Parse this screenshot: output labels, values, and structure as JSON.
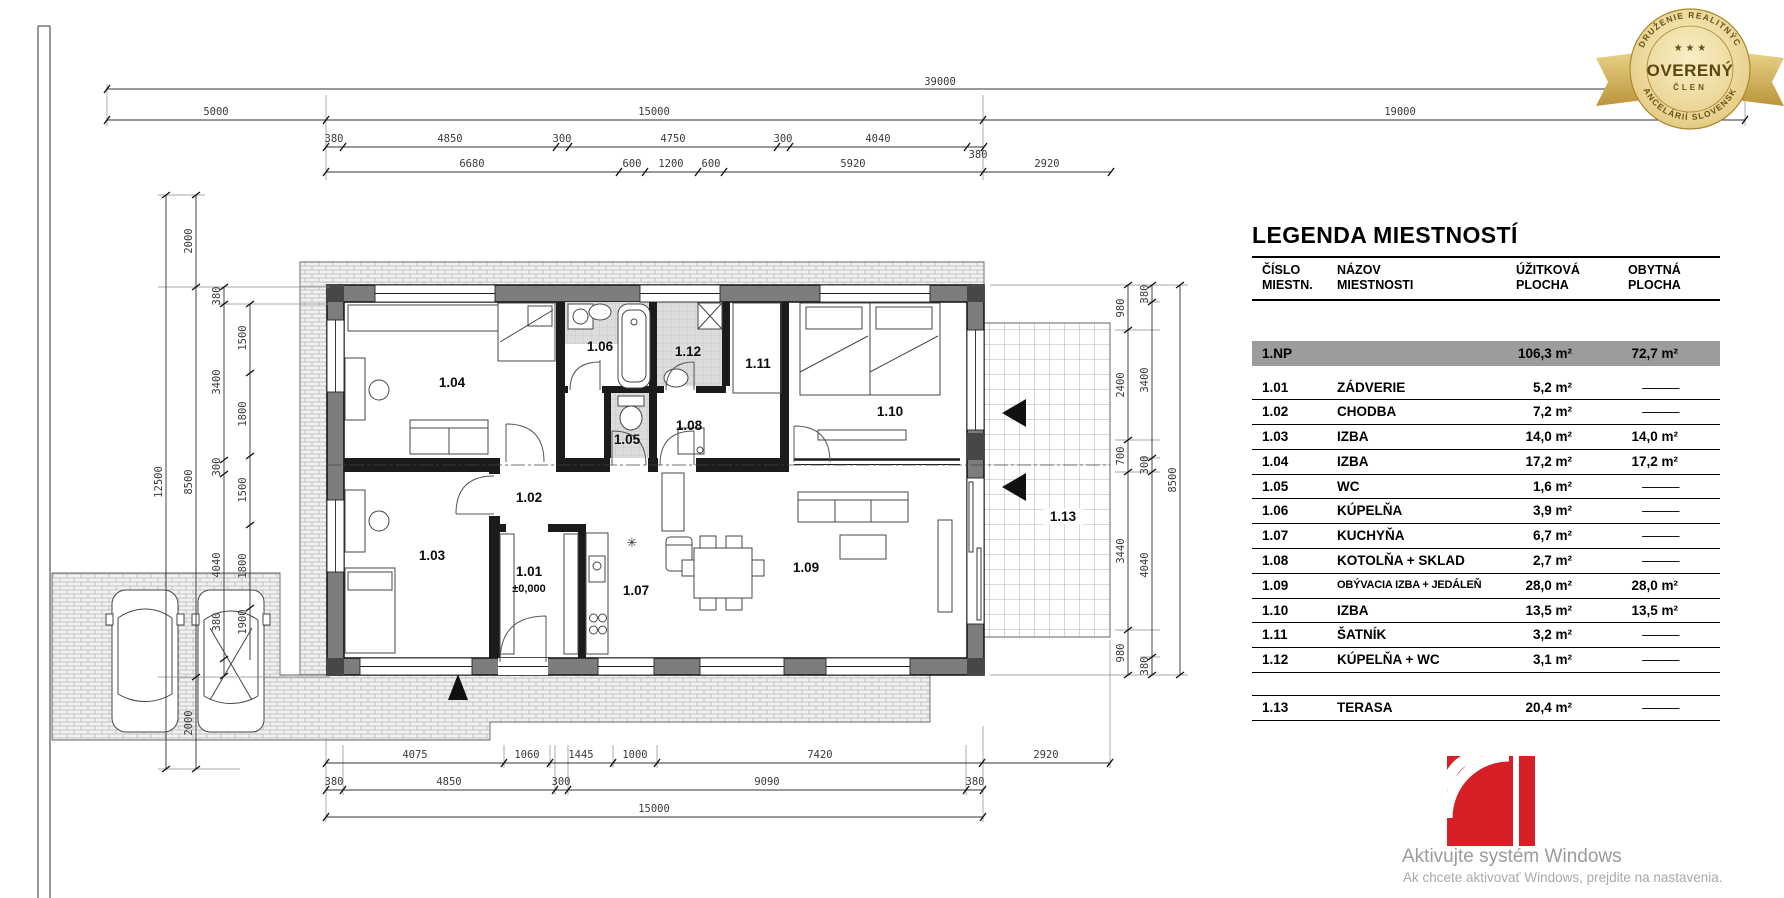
{
  "plan": {
    "rooms": [
      {
        "id": "1.01"
      },
      {
        "id": "1.02"
      },
      {
        "id": "1.03"
      },
      {
        "id": "1.04"
      },
      {
        "id": "1.05"
      },
      {
        "id": "1.06"
      },
      {
        "id": "1.07"
      },
      {
        "id": "1.08"
      },
      {
        "id": "1.09"
      },
      {
        "id": "1.10"
      },
      {
        "id": "1.11"
      },
      {
        "id": "1.12"
      },
      {
        "id": "1.13"
      }
    ],
    "level_mark": "±0,000"
  },
  "dims": {
    "top": {
      "total": "39000",
      "row2": [
        "5000",
        "15000",
        "19000"
      ],
      "row3": [
        "380",
        "4850",
        "300",
        "4750",
        "300",
        "4040",
        "380"
      ],
      "row4": [
        "6680",
        "600",
        "1200",
        "600",
        "5920",
        "2920"
      ]
    },
    "bottom": {
      "row1": [
        "4075",
        "1060",
        "1445",
        "1000",
        "7420",
        "2920"
      ],
      "row2": [
        "380",
        "4850",
        "300",
        "9090",
        "380"
      ],
      "total": "15000"
    },
    "left": {
      "col1": "12500",
      "col2": [
        "2000",
        "8500",
        "2000"
      ],
      "col3": [
        "380",
        "3400",
        "300",
        "4040",
        "380"
      ],
      "col4": [
        "1500",
        "1800",
        "1500",
        "1800",
        "1900"
      ]
    },
    "right": {
      "col1": [
        "980",
        "2400",
        "700",
        "3440",
        "980"
      ],
      "col2": [
        "380",
        "3400",
        "300",
        "4040",
        "380"
      ],
      "col3": "8500"
    }
  },
  "legend": {
    "title": "LEGENDA MIESTNOSTÍ",
    "headers": {
      "col1a": "ČÍSLO",
      "col1b": "MIESTN.",
      "col2a": "NÁZOV",
      "col2b": "MIESTNOSTI",
      "col3a": "ÚŽITKOVÁ",
      "col3b": "PLOCHA",
      "col4a": "OBYTNÁ",
      "col4b": "PLOCHA"
    },
    "summary": {
      "num": "1.NP",
      "util": "106,3 m²",
      "living": "72,7 m²"
    },
    "rows": [
      {
        "num": "1.01",
        "name": "ZÁDVERIE",
        "util": "5,2 m²",
        "living": "———"
      },
      {
        "num": "1.02",
        "name": "CHODBA",
        "util": "7,2 m²",
        "living": "———"
      },
      {
        "num": "1.03",
        "name": "IZBA",
        "util": "14,0 m²",
        "living": "14,0 m²"
      },
      {
        "num": "1.04",
        "name": "IZBA",
        "util": "17,2 m²",
        "living": "17,2 m²"
      },
      {
        "num": "1.05",
        "name": "WC",
        "util": "1,6 m²",
        "living": "———"
      },
      {
        "num": "1.06",
        "name": "KÚPELŇA",
        "util": "3,9 m²",
        "living": "———"
      },
      {
        "num": "1.07",
        "name": "KUCHYŇA",
        "util": "6,7 m²",
        "living": "———"
      },
      {
        "num": "1.08",
        "name": "KOTOLŇA + SKLAD",
        "util": "2,7 m²",
        "living": "———"
      },
      {
        "num": "1.09",
        "name": "OBÝVACIA IZBA + JEDÁLEŇ",
        "util": "28,0 m²",
        "living": "28,0 m²"
      },
      {
        "num": "1.10",
        "name": "IZBA",
        "util": "13,5 m²",
        "living": "13,5 m²"
      },
      {
        "num": "1.11",
        "name": "ŠATNÍK",
        "util": "3,2 m²",
        "living": "———"
      },
      {
        "num": "1.12",
        "name": "KÚPELŇA + WC",
        "util": "3,1 m²",
        "living": "———"
      }
    ],
    "terrace_row": {
      "num": "1.13",
      "name": "TERASA",
      "util": "20,4 m²",
      "living": "———"
    }
  },
  "badge": {
    "ring_top": "ZDRUŽENIE REALITNÝCH",
    "ring_bottom": "KANCELÁRIÍ SLOVENSKA",
    "stars": "★ ★ ★",
    "center": "OVERENÝ",
    "member": "ČLEN"
  },
  "watermark": {
    "line1": "Aktivujte systém Windows",
    "line2": "Ak chcete aktivovať Windows, prejdite na nastavenia."
  },
  "colors": {
    "accent_red": "#d71f26",
    "badge_gold": "#c9a43a",
    "wall_gray": "#7d7d7d"
  }
}
